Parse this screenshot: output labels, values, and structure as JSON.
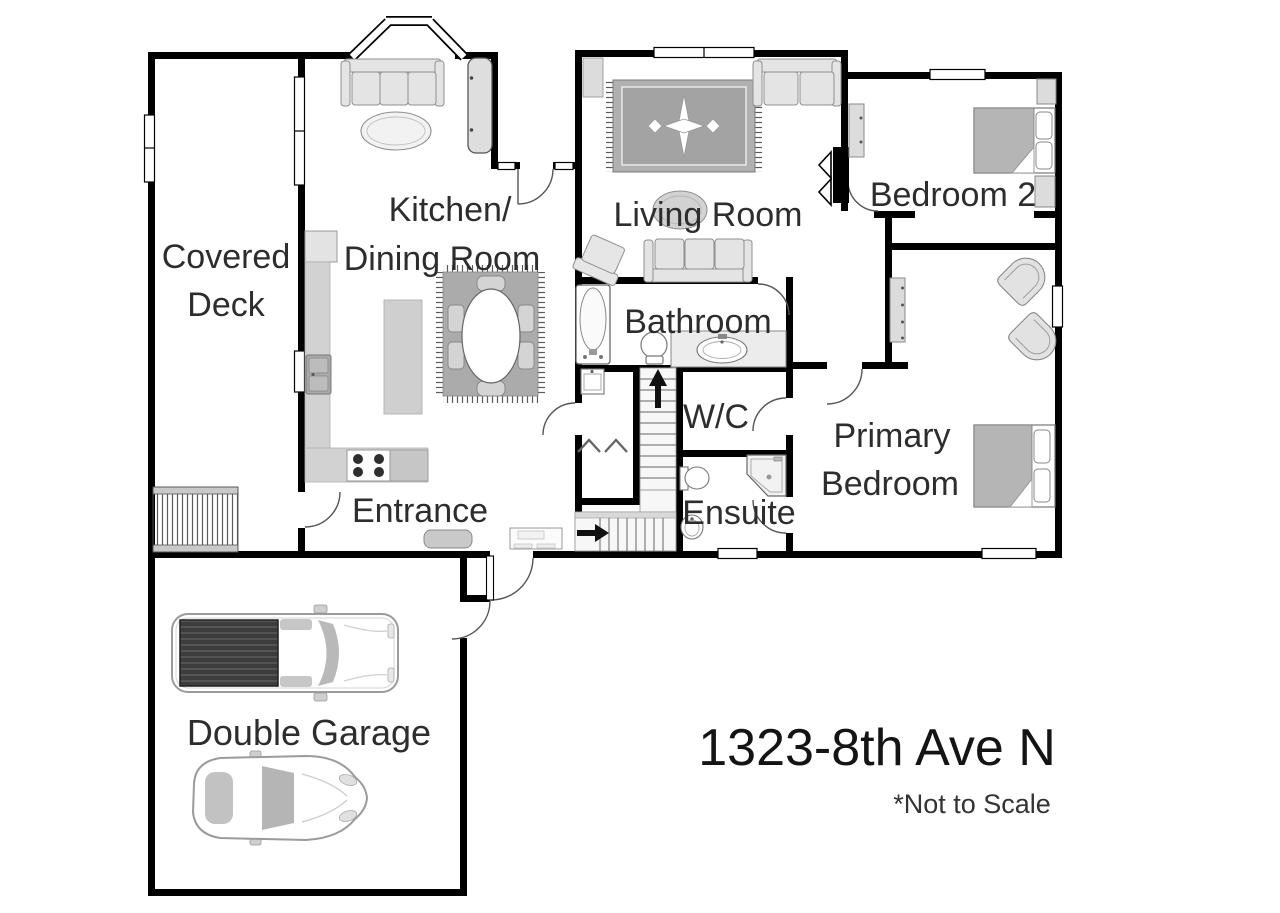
{
  "floor_plan": {
    "title": "1323-8th Ave N",
    "scale_note": "*Not to Scale",
    "labels": {
      "covered_deck_line1": "Covered",
      "covered_deck_line2": "Deck",
      "kitchen_line1": "Kitchen/",
      "kitchen_line2": "Dining Room",
      "living_room": "Living Room",
      "bedroom2": "Bedroom 2",
      "bathroom": "Bathroom",
      "wc": "W/C",
      "primary_line1": "Primary",
      "primary_line2": "Bedroom",
      "ensuite": "Ensuite",
      "entrance": "Entrance",
      "garage": "Double Garage"
    },
    "colors": {
      "wall": "#000000",
      "text": "#2d2d2d",
      "furniture_light": "#e4e4e4",
      "furniture_mid": "#d2d2d2",
      "rug": "#ababab",
      "mattress": "#b5b5b5",
      "truck_bed": "#3d3d3d"
    }
  }
}
